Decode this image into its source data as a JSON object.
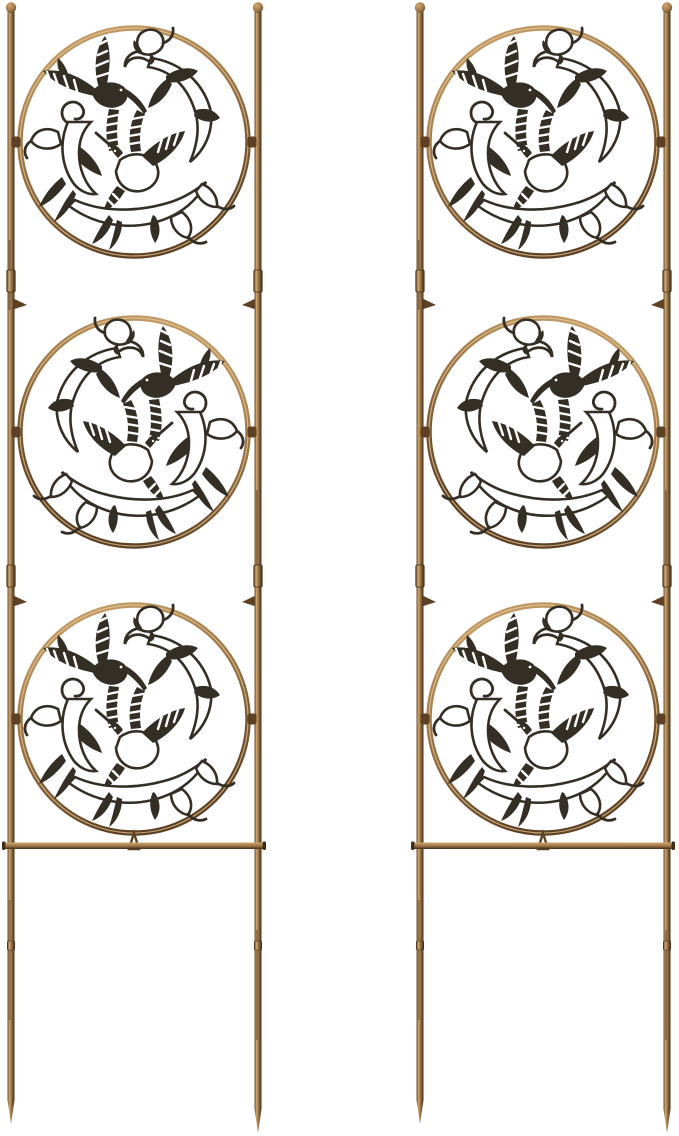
{
  "scene": {
    "type": "product-photo",
    "subject": "Pair of antique-bronze metal garden trellis panels with hummingbird medallions",
    "background": "plain white studio backdrop",
    "panel_count": 2,
    "medallions_per_panel": 3,
    "motif": "hummingbirds among trumpet-vine flowers and leaf scrollwork",
    "finish": "brushed antique bronze / copper"
  },
  "colors": {
    "background": "#ffffff",
    "bronze_light": "#cfa871",
    "bronze_mid": "#9c7446",
    "bronze_dark": "#5e4124",
    "bronze_deep": "#3f2d18",
    "silhouette": "#352e25",
    "highlight": "#e8cfa0"
  },
  "panels": [
    {
      "name": "left-trellis",
      "label": "Left trellis panel",
      "x_offset": 0
    },
    {
      "name": "right-trellis",
      "label": "Right trellis panel",
      "x_offset": 409
    }
  ],
  "panel_parts": {
    "finial": "ball finial",
    "rod_left": "left upright rod with pointed ground stake",
    "rod_right": "right upright rod with pointed ground stake",
    "sleeve": "rod coupling sleeve",
    "hook": "plant support hook",
    "clamp": "medallion mounting clamp",
    "crossbar": "bottom horizontal crossbar",
    "medallions": [
      {
        "position": "top",
        "center_y": 142,
        "mirrored": false
      },
      {
        "position": "middle",
        "center_y": 432,
        "mirrored": true
      },
      {
        "position": "bottom",
        "center_y": 719,
        "mirrored": false
      }
    ],
    "medallion_contents": "two hummingbirds with striped wings, scroll bands, trumpet flowers, leaves"
  }
}
